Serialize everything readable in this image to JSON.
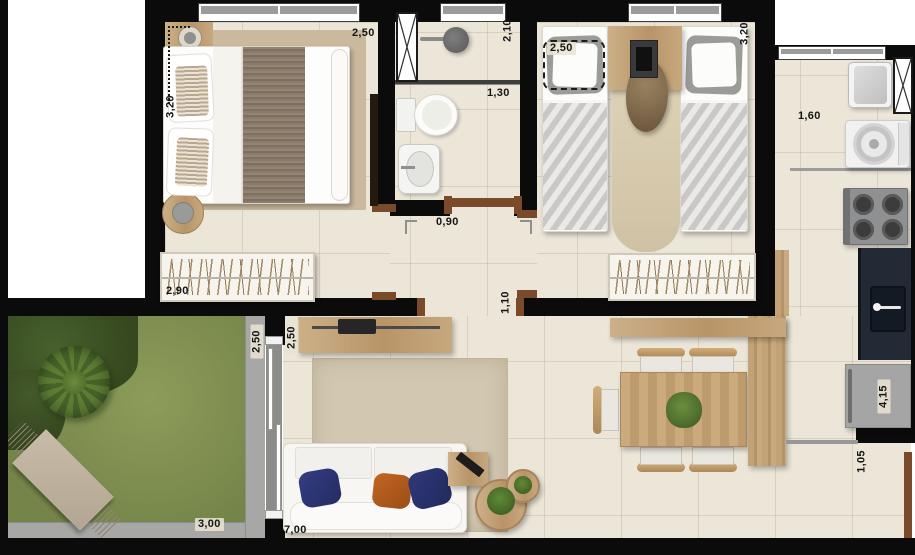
{
  "plan": {
    "dimensions": {
      "bedroom1_height": "3,20",
      "bedroom1_width": "2,50",
      "bedroom1_wardrobe_width": "2,90",
      "bathroom_shower_width": "2,10",
      "bathroom_width": "1,30",
      "bedroom2_bed_width": "2,50",
      "bedroom2_height": "3,20",
      "kitchen_width": "1,60",
      "hall_door_width": "0,90",
      "hall_opening_width": "1,10",
      "garden_depth": "2,50",
      "living_depth": "2,50",
      "garden_width": "3,00",
      "living_width": "7,00",
      "kitchen_run_length": "4,15",
      "entry_passage_width": "1,05"
    },
    "colors": {
      "wall": "#0b0b0b",
      "floor": "#ece6d9",
      "wood": "#c5a478",
      "grass": "#7f8e50",
      "path": "#a7a7a5",
      "counter_dark": "#222a35",
      "door_frame": "#7a4a2b",
      "pillow_navy": "#2c3572",
      "pillow_orange": "#b25a1e"
    }
  }
}
